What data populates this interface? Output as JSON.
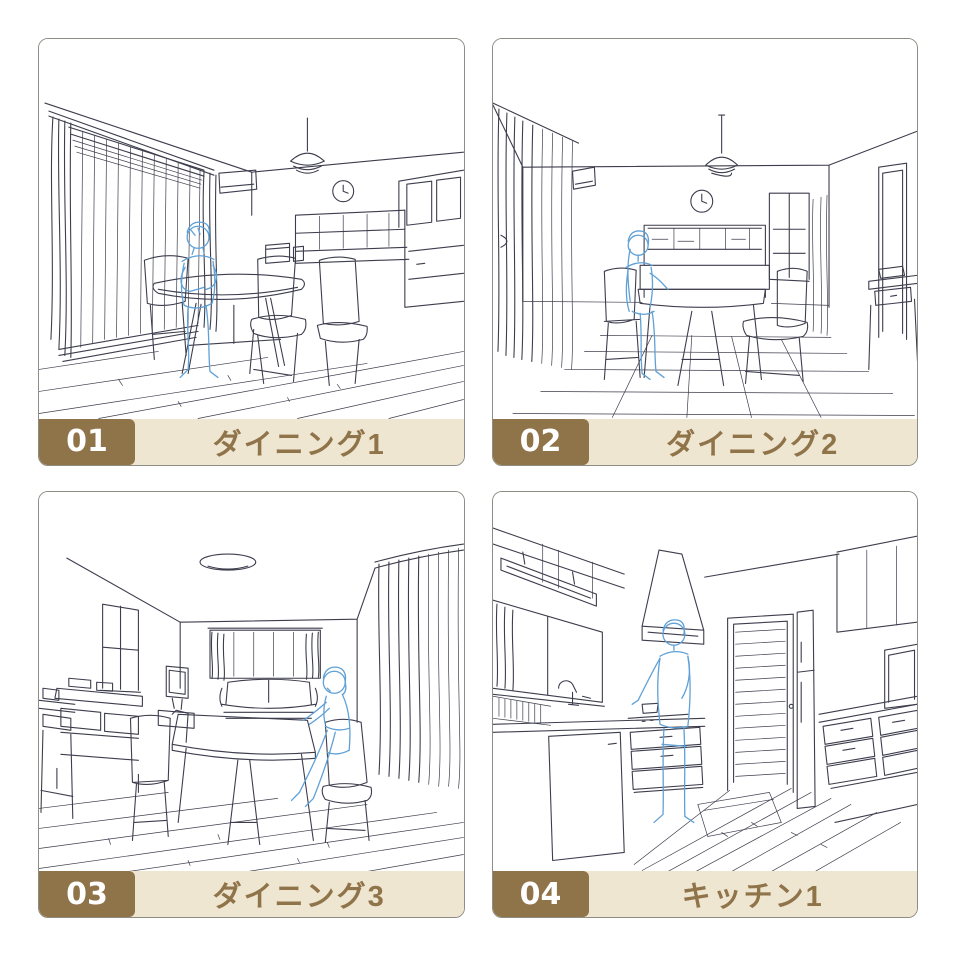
{
  "colors": {
    "accent_brown": "#8f7349",
    "bar_beige": "#efe6d2",
    "panel_border": "#8e8d85",
    "line_art": "#3d3d4d",
    "figure_blue": "#5fa0d6",
    "page_bg": "#ffffff",
    "number_text": "#ffffff"
  },
  "panels": [
    {
      "number": "01",
      "label": "ダイニング1",
      "scene": "dining room line drawing, window curtains left, kitchen counter right, seated figure at oval table"
    },
    {
      "number": "02",
      "label": "ダイニング2",
      "scene": "dining room line drawing, frontal view, counter hutch at back, pendant lamp, seated figure at table"
    },
    {
      "number": "03",
      "label": "ダイニング3",
      "scene": "dining room line drawing, sofa and window at back, large table, seated figure at right, curtains right"
    },
    {
      "number": "04",
      "label": "キッチン1",
      "scene": "kitchen line drawing, sink counter left, range hood, standing figure cooking, louvered door at back"
    }
  ]
}
